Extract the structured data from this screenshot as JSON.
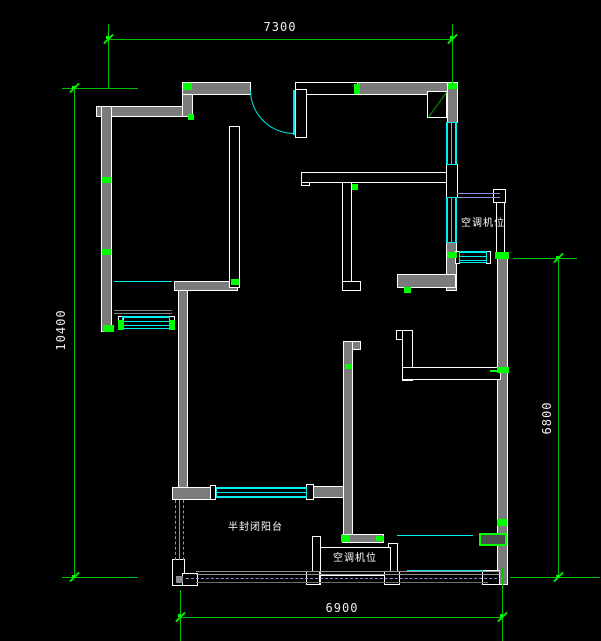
{
  "drawing": {
    "type": "cad-floor-plan",
    "dimensions": {
      "top": "7300",
      "left": "10400",
      "right": "6800",
      "bottom": "6900"
    },
    "labels": {
      "ac_right": "空调机位",
      "ac_bottom": "空调机位",
      "balcony": "半封闭阳台"
    },
    "colors": {
      "background": "#000000",
      "wall_fill": "#7b7b7b",
      "wall_edge": "#ffffff",
      "window": "#00f0f0",
      "door": "#00e5e5",
      "dimension_line": "#00bf00",
      "junction_marker": "#00ff00",
      "balcony_dash": "#8d8dd8",
      "dimension_text": "#ededed",
      "label_text": "#ffffff"
    }
  }
}
